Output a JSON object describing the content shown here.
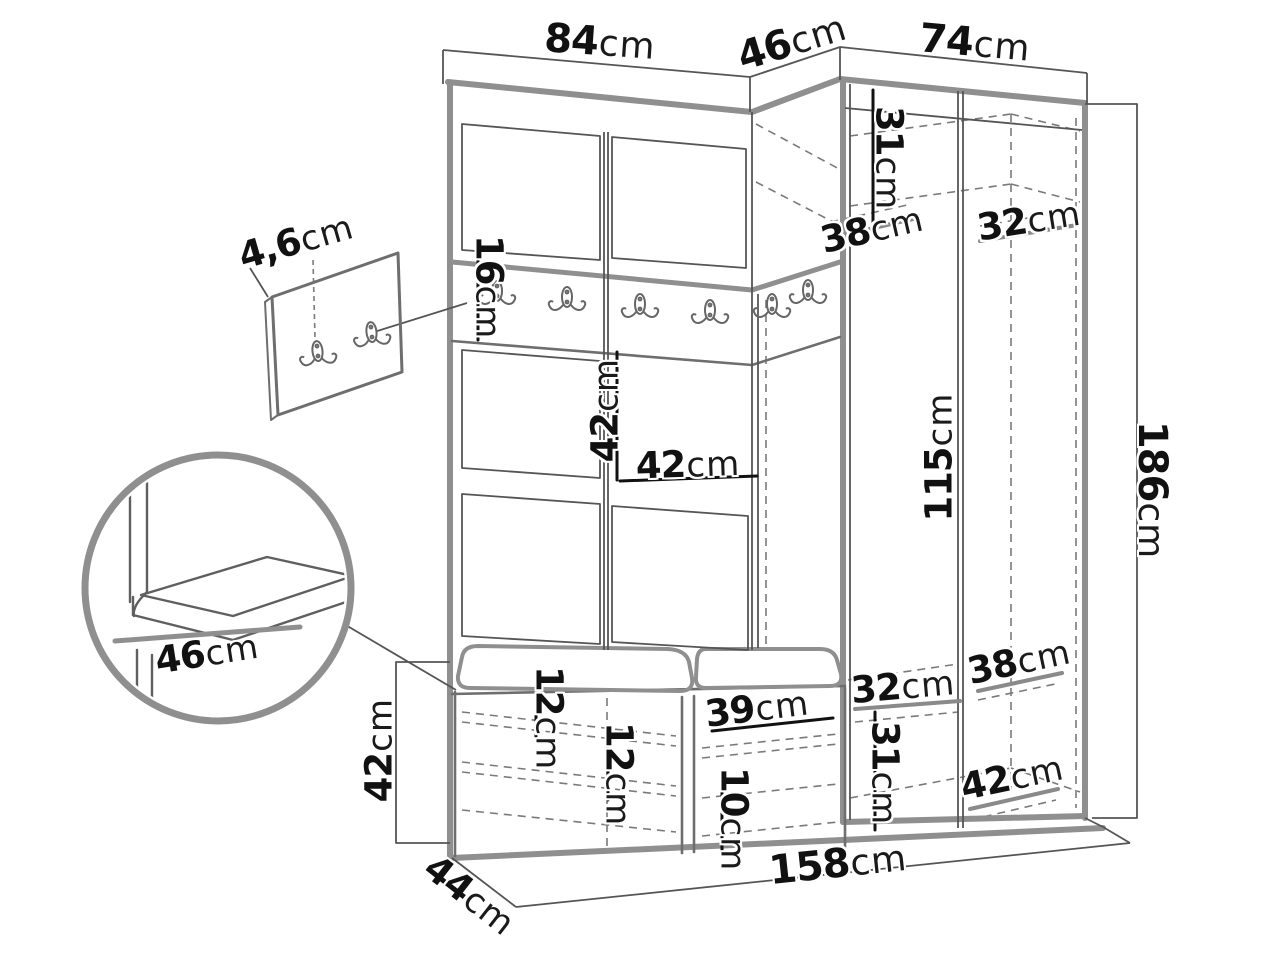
{
  "palette": {
    "background": "#ffffff",
    "main_lines": "#8f8f8f",
    "detail_lines": "#5a5a5a",
    "hidden_lines": "#777777",
    "dimension_ref_lines": "#111111",
    "label_text": "#111111"
  },
  "drawing": {
    "type": "furniture-dimension-diagram",
    "subject": "hallway wardrobe set with coat hooks, corner wardrobe and shoe bench",
    "icons": [
      "coat-hook-icon"
    ]
  },
  "dims": {
    "top_left_width": {
      "value": "84",
      "unit": "cm"
    },
    "top_corner_width": {
      "value": "46",
      "unit": "cm"
    },
    "top_right_width": {
      "value": "74",
      "unit": "cm"
    },
    "upper_corner_height": {
      "value": "31",
      "unit": "cm"
    },
    "upper_corner_depth": {
      "value": "38",
      "unit": "cm"
    },
    "upper_right_depth": {
      "value": "32",
      "unit": "cm"
    },
    "panel_thickness": {
      "value": "4,6",
      "unit": "cm"
    },
    "rail_height": {
      "value": "16",
      "unit": "cm"
    },
    "niche_height": {
      "value": "42",
      "unit": "cm"
    },
    "niche_width": {
      "value": "42",
      "unit": "cm"
    },
    "open_section_height": {
      "value": "115",
      "unit": "cm"
    },
    "total_height": {
      "value": "186",
      "unit": "cm"
    },
    "seat_depth": {
      "value": "46",
      "unit": "cm"
    },
    "lower_right_depth": {
      "value": "38",
      "unit": "cm"
    },
    "lower_middle_width": {
      "value": "32",
      "unit": "cm"
    },
    "bench_height": {
      "value": "42",
      "unit": "cm"
    },
    "shoe_shelf_gap_1": {
      "value": "12",
      "unit": "cm"
    },
    "shoe_shelf_gap_2": {
      "value": "12",
      "unit": "cm"
    },
    "shoe_shelf_width": {
      "value": "39",
      "unit": "cm"
    },
    "shoe_shelf_gap_3": {
      "value": "10",
      "unit": "cm"
    },
    "lower_right_height": {
      "value": "31",
      "unit": "cm"
    },
    "lower_right_depth_2": {
      "value": "42",
      "unit": "cm"
    },
    "total_width": {
      "value": "158",
      "unit": "cm"
    },
    "bench_depth": {
      "value": "44",
      "unit": "cm"
    }
  }
}
